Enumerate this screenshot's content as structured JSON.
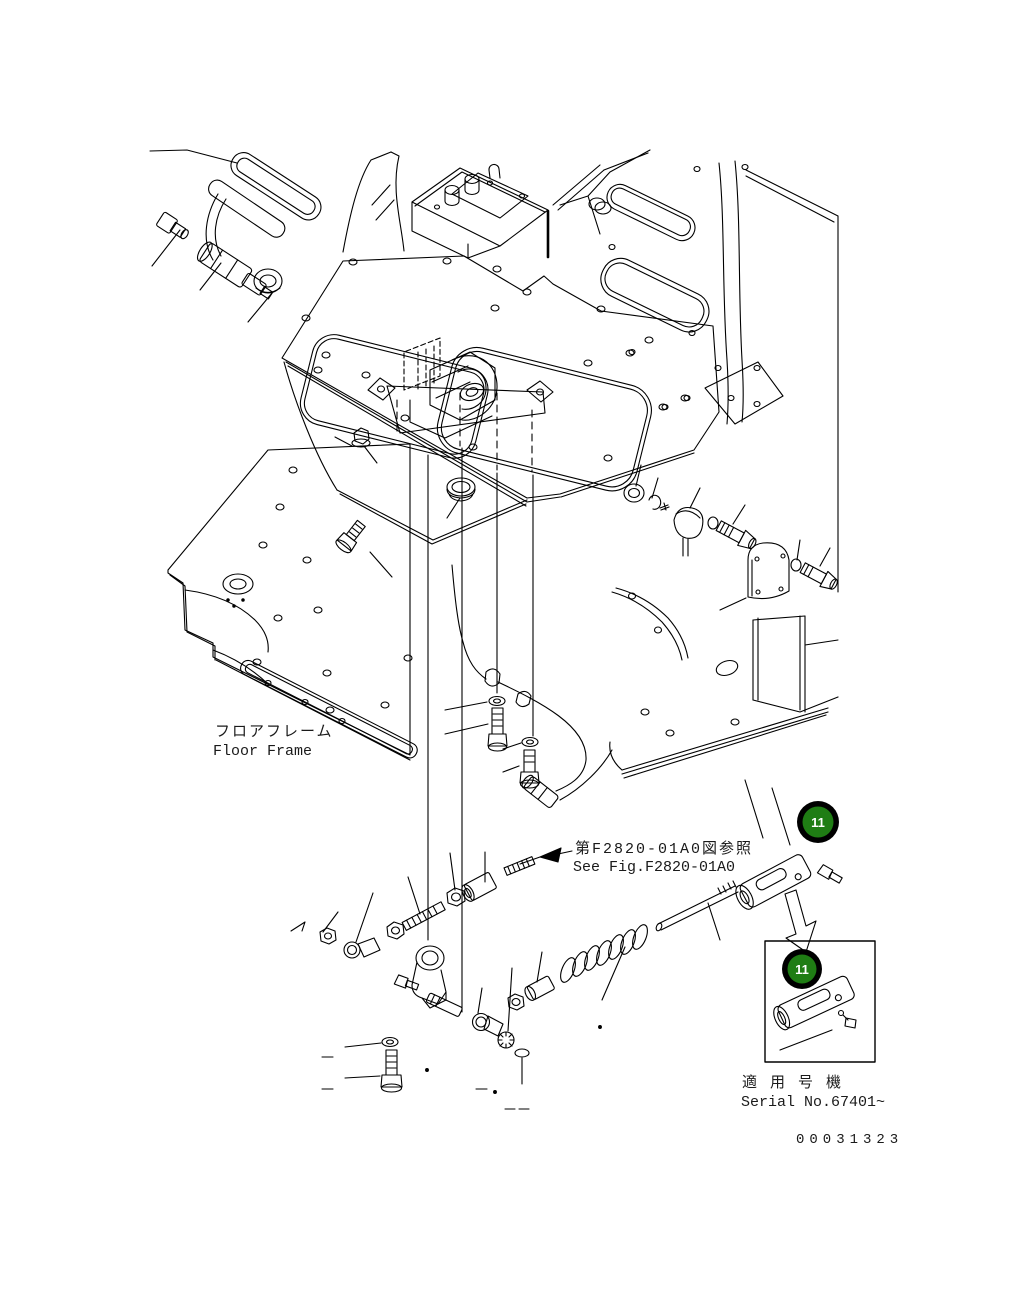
{
  "drawing": {
    "type": "parts-exploded-diagram",
    "labels": {
      "floor_frame": {
        "jp": "フロアフレーム",
        "en": "Floor Frame"
      },
      "reference": {
        "jp": "第F2820-01A0図参照",
        "en": "See Fig.F2820-01A0"
      },
      "applicable_serial": {
        "jp": "適 用 号 機",
        "en": "Serial No.67401~"
      },
      "doc_number": "00031323"
    },
    "callouts": [
      {
        "id": "11"
      },
      {
        "id": "11"
      }
    ],
    "colors": {
      "callout_fill": "#1f7d14",
      "callout_ring": "#000000",
      "callout_text": "#ffffff",
      "line": "#000000",
      "background": "#ffffff"
    }
  }
}
